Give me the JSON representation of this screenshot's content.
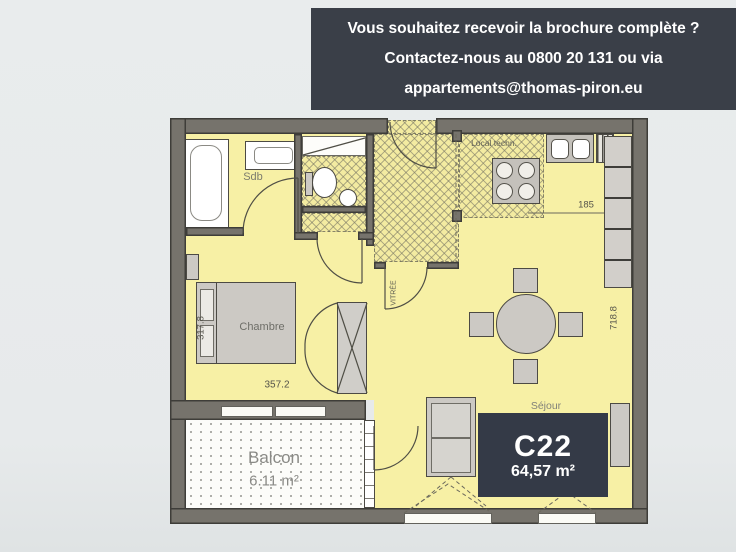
{
  "banner": {
    "bg": "#3a3f48",
    "lines": [
      "Vous souhaitez recevoir la brochure complète ?",
      "Contactez-nous au 0800 20 131 ou via",
      "appartements@thomas-piron.eu"
    ]
  },
  "plan": {
    "labels": {
      "sdb": "Sdb",
      "chambre": "Chambre",
      "local_techn": "Local techn.",
      "sejour": "Séjour",
      "balcon": "Balcon",
      "balcon_area": "6.11 m²",
      "entry_door": "VITRÉE"
    },
    "dimensions": {
      "chambre_width": "357.2",
      "chambre_depth": "317.8",
      "sejour_depth": "718.8",
      "kitchen_width": "185"
    },
    "badge": {
      "unit": "C22",
      "area": "64,57 m²"
    }
  },
  "colors": {
    "banner_bg": "#3a3f48",
    "floor": "#f7f0a5",
    "wall": "#76736c",
    "badge_bg": "#343a47",
    "furniture": "#ccc9c4",
    "balcony": "#fcfcf9"
  }
}
